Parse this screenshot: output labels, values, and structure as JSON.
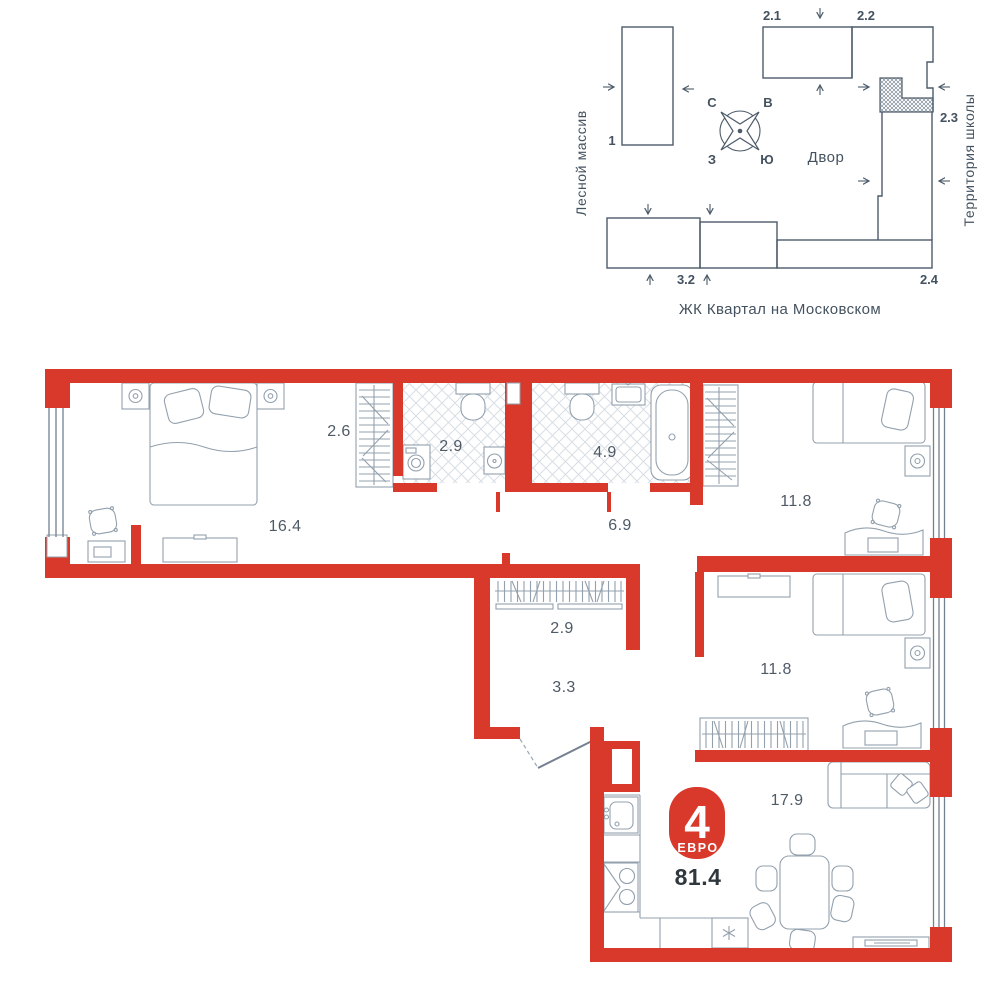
{
  "site_plan": {
    "area_left_label": "Лесной массив",
    "area_right_label": "Территория школы",
    "courtyard_label": "Двор",
    "caption": "ЖК Квартал на Московском",
    "compass": {
      "north": "С",
      "east": "В",
      "west": "З",
      "south": "Ю"
    },
    "building_labels": {
      "b1": "1",
      "b21": "2.1",
      "b22": "2.2",
      "b23": "2.3",
      "b24": "2.4",
      "b32": "3.2"
    }
  },
  "floor_plan": {
    "badge": {
      "rooms_count": "4",
      "type_label": "ЕВРО",
      "total_area": "81.4"
    },
    "rooms": {
      "master_bedroom": "16.4",
      "master_wardrobe": "2.6",
      "wc": "2.9",
      "bathroom": "4.9",
      "corridor": "6.9",
      "bedroom_1": "11.8",
      "bedroom_2": "11.8",
      "hall_closet": "2.9",
      "hallway": "3.3",
      "kitchen_living": "17.9"
    }
  },
  "colors": {
    "wall_red": "#d8392b",
    "site_line": "#4d5b69",
    "furniture_line": "#93a0ad",
    "room_label": "#4e5a66",
    "total_text": "#30373d"
  }
}
